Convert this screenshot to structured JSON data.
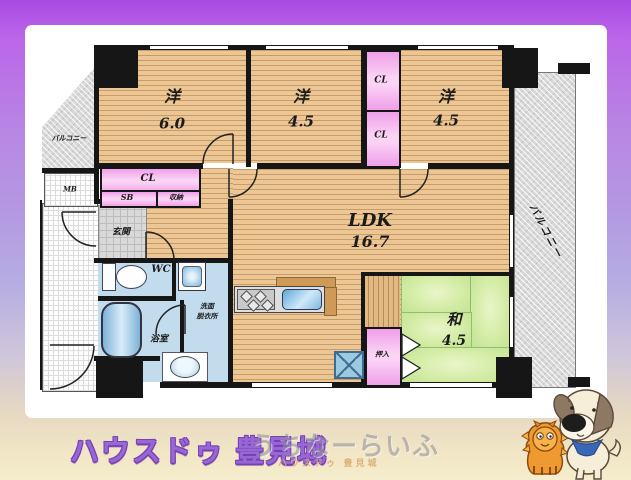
{
  "rooms": {
    "western1": {
      "name": "洋",
      "area": "6.0"
    },
    "western2": {
      "name": "洋",
      "area": "4.5"
    },
    "western3": {
      "name": "洋",
      "area": "4.5"
    },
    "ldk": {
      "name": "LDK",
      "area": "16.7"
    },
    "japanese": {
      "name": "和",
      "area": "4.5"
    }
  },
  "closets": {
    "cl_upper": "CL",
    "cl_lower": "CL",
    "cl_hall": "CL",
    "sb": "SB",
    "shuno": "収納",
    "oshiire": "押入"
  },
  "spaces": {
    "mb": "MB",
    "genkan": "玄関",
    "wc": "WC",
    "senmen_line1": "洗面",
    "senmen_line2": "脱衣所",
    "bath": "浴室",
    "balcony_left": "バルコニー",
    "balcony_right": "バルコニー"
  },
  "branding": {
    "agency": "ハウスドゥ 豊見城",
    "watermark": "うちなーらいふ",
    "watermark_sub": "ハウスドゥ  豊見城"
  },
  "colors": {
    "frame_purple": "#b060e8",
    "wood_floor": "#ecc795",
    "closet_pink": "#f7b6ef",
    "tatami_green": "#d3eca5",
    "wet_area_blue": "#c2dcee",
    "wall_black": "#161616",
    "brand_purple": "#9668d4"
  }
}
